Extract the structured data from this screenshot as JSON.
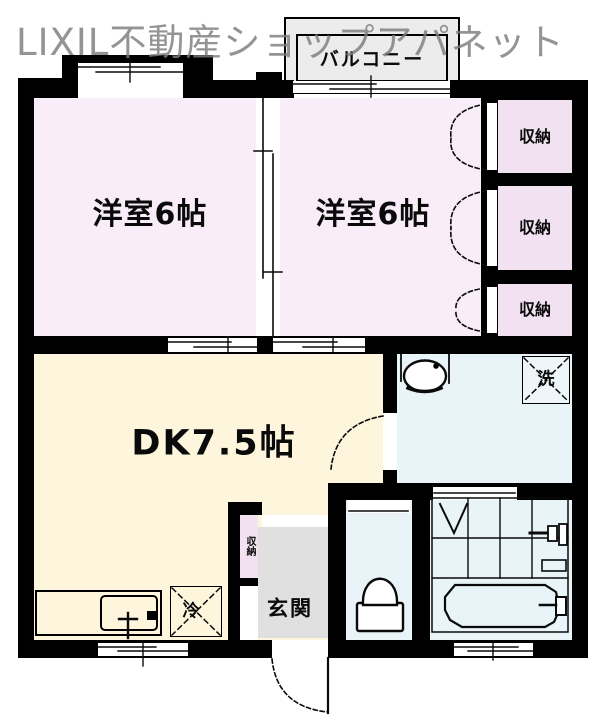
{
  "watermark": {
    "text": "LIXIL不動産ショップアパネット"
  },
  "plan": {
    "balcony": {
      "label": "バルコニー"
    },
    "rooms": {
      "bedroom_left": {
        "label": "洋室6帖",
        "floor_color": "#f8edf8"
      },
      "bedroom_right": {
        "label": "洋室6帖",
        "floor_color": "#f8edf8"
      },
      "dining_kitchen": {
        "label": "DK7.5帖",
        "floor_color": "#fdf6dd"
      },
      "entrance": {
        "label": "玄関",
        "floor_color": "#e0e0e0"
      }
    },
    "closets": [
      {
        "label": "収納"
      },
      {
        "label": "収納"
      },
      {
        "label": "収納"
      }
    ],
    "hall_closet": {
      "label": "収納"
    },
    "fixtures": {
      "washing_machine": {
        "label": "洗"
      },
      "refrigerator": {
        "label": "冷"
      }
    },
    "colors": {
      "wall": "#000000",
      "bedroom_pink": "#f8edf8",
      "closet_pink": "#f2e1f0",
      "dk_cream": "#fdf6dd",
      "water_blue": "#e9f4f8",
      "entrance_gray": "#e0e0e0",
      "balcony_gray": "#ececec",
      "watermark_gray": "#7d7d7d"
    }
  }
}
